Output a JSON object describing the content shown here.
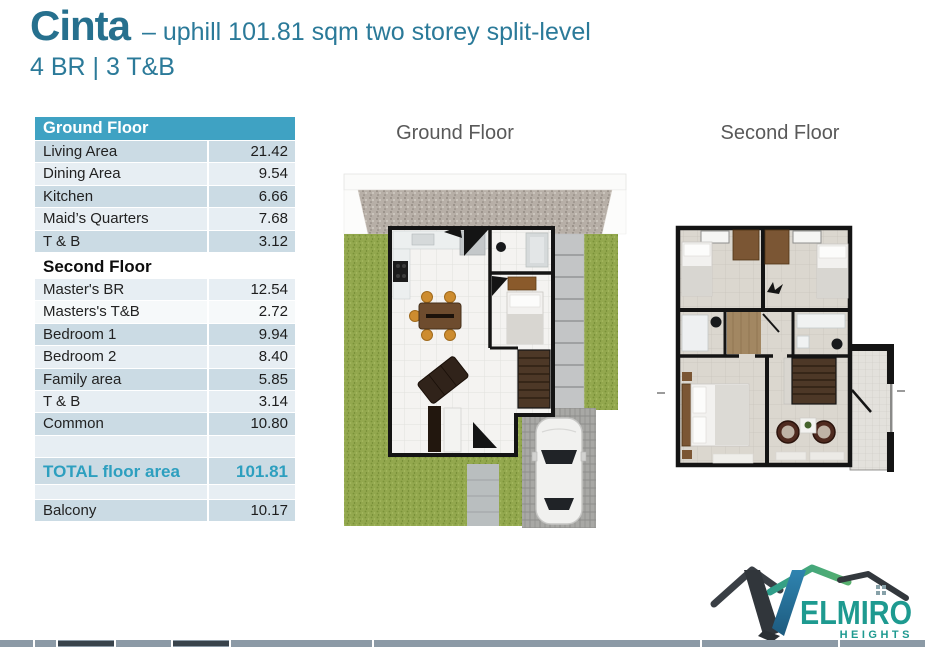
{
  "header": {
    "title": "Cinta",
    "subtitle": "– uphill 101.81 sqm two storey split-level",
    "spec": "4 BR | 3 T&B"
  },
  "table": {
    "rows": [
      {
        "type": "header",
        "label": "Ground Floor",
        "value": "",
        "shade": ""
      },
      {
        "type": "data",
        "label": "Living Area",
        "value": "21.42",
        "shade": "d"
      },
      {
        "type": "data",
        "label": "Dining Area",
        "value": "9.54",
        "shade": "l"
      },
      {
        "type": "data",
        "label": "Kitchen",
        "value": "6.66",
        "shade": "d"
      },
      {
        "type": "data",
        "label": "Maid’s Quarters",
        "value": "7.68",
        "shade": "l"
      },
      {
        "type": "data",
        "label": "T & B",
        "value": "3.12",
        "shade": "d"
      },
      {
        "type": "section",
        "label": "Second Floor",
        "value": "",
        "shade": ""
      },
      {
        "type": "data",
        "label": "Master's BR",
        "value": "12.54",
        "shade": "l"
      },
      {
        "type": "data",
        "label": "Masters's T&B",
        "value": "2.72",
        "shade": "w"
      },
      {
        "type": "data",
        "label": "Bedroom 1",
        "value": "9.94",
        "shade": "d"
      },
      {
        "type": "data",
        "label": "Bedroom 2",
        "value": "8.40",
        "shade": "l"
      },
      {
        "type": "data",
        "label": "Family area",
        "value": "5.85",
        "shade": "d"
      },
      {
        "type": "data",
        "label": "T & B",
        "value": "3.14",
        "shade": "l"
      },
      {
        "type": "data",
        "label": "Common",
        "value": "10.80",
        "shade": "d"
      },
      {
        "type": "spacer",
        "label": "",
        "value": "",
        "shade": "l"
      },
      {
        "type": "total",
        "label": "TOTAL floor area",
        "value": "101.81",
        "shade": "d"
      },
      {
        "type": "spacer-sm",
        "label": "",
        "value": "",
        "shade": "l"
      },
      {
        "type": "data",
        "label": "Balcony",
        "value": "10.17",
        "shade": "d"
      }
    ]
  },
  "plans": {
    "ground": {
      "title": "Ground Floor"
    },
    "second": {
      "title": "Second Floor"
    }
  },
  "logo": {
    "brand": "VELMIRO",
    "wordmark": "ELMIRO",
    "subtext": "HEIGHTS"
  },
  "colors": {
    "accent_teal": "#26708E",
    "table_header_bg": "#3FA2C3",
    "row_dark": "#CBDBE4",
    "row_light": "#E7EEF3",
    "total_text": "#2D9FBF",
    "grass_green": "#93A84E",
    "gravel_gray": "#B7AFA7",
    "logo_teal": "#1E9A90"
  }
}
